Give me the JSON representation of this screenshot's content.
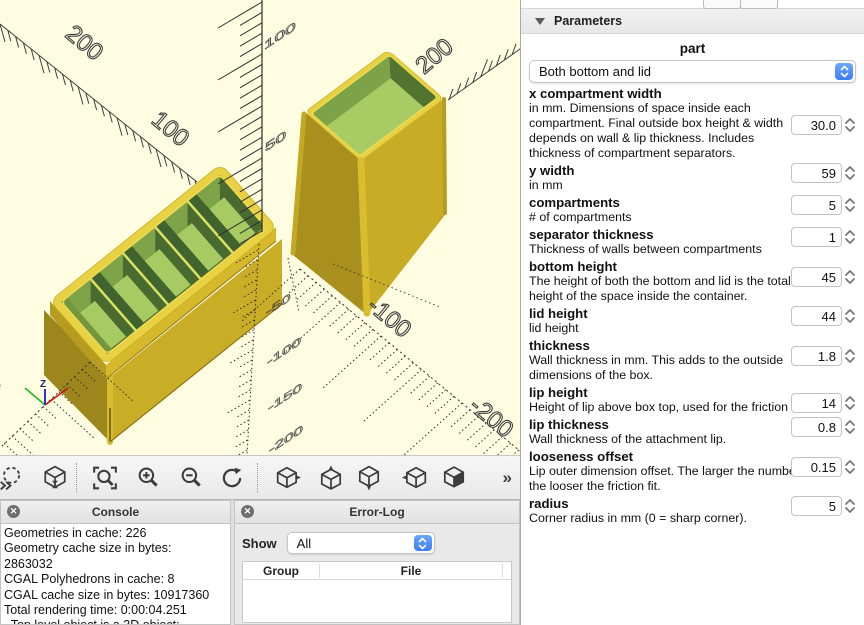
{
  "viewport": {
    "axis_labels": {
      "x_200": "200",
      "x_100": "100",
      "y_200": "200",
      "xneg_100": "-100",
      "xneg_200": "-200",
      "yneg_200": "-200",
      "z_100": "100",
      "z_50": "50",
      "zneg_50": "-50",
      "zneg_100": "-100",
      "zneg_150": "-150",
      "zneg_200": "-200"
    },
    "origin_axis_label": "Z",
    "colors": {
      "background": "#FFFDE1",
      "box_yellow": "#D9BD2F",
      "box_interior_green": "#A7CB62",
      "axis_line": "#3F3F3F"
    }
  },
  "toolbar": {
    "overflow_label": "»"
  },
  "console": {
    "title": "Console",
    "lines": [
      "Geometries in cache: 226",
      "Geometry cache size in bytes:",
      "2863032",
      "CGAL Polyhedrons in cache: 8",
      "CGAL cache size in bytes: 10917360",
      "Total rendering time: 0:00:04.251",
      "  Top level object is a 3D object:"
    ]
  },
  "error_log": {
    "title": "Error-Log",
    "show_label": "Show",
    "show_value": "All",
    "columns": [
      "Group",
      "File"
    ]
  },
  "parameters": {
    "title": "Parameters",
    "part_label": "part",
    "part_value": "Both bottom and lid",
    "params": [
      {
        "name": "x compartment width",
        "desc": "in mm. Dimensions of space inside each compartment. Final outside box height & width depends on wall & lip thickness. Includes thickness of compartment separators.",
        "value": "30.0"
      },
      {
        "name": "y width",
        "desc": "in mm",
        "value": "59"
      },
      {
        "name": "compartments",
        "desc": "# of compartments",
        "value": "5"
      },
      {
        "name": "separator thickness",
        "desc": "Thickness of walls between compartments",
        "value": "1"
      },
      {
        "name": "bottom height",
        "desc": "The height of both the bottom and lid is the total height of the space inside the container.",
        "value": "45"
      },
      {
        "name": "lid height",
        "desc": "lid height",
        "value": "44"
      },
      {
        "name": "thickness",
        "desc": "Wall thickness in mm. This adds to the outside dimensions of the box.",
        "value": "1.8"
      },
      {
        "name": "lip height",
        "desc": "Height of lip above box top, used for the friction fit.",
        "value": "14"
      },
      {
        "name": "lip thickness",
        "desc": "Wall thickness of the attachment lip.",
        "value": "0.8"
      },
      {
        "name": "looseness offset",
        "desc": "Lip outer dimension offset. The larger the number the looser the friction fit.",
        "value": "0.15"
      },
      {
        "name": "radius",
        "desc": "Corner radius in mm (0 = sharp corner).",
        "value": "5"
      }
    ]
  }
}
